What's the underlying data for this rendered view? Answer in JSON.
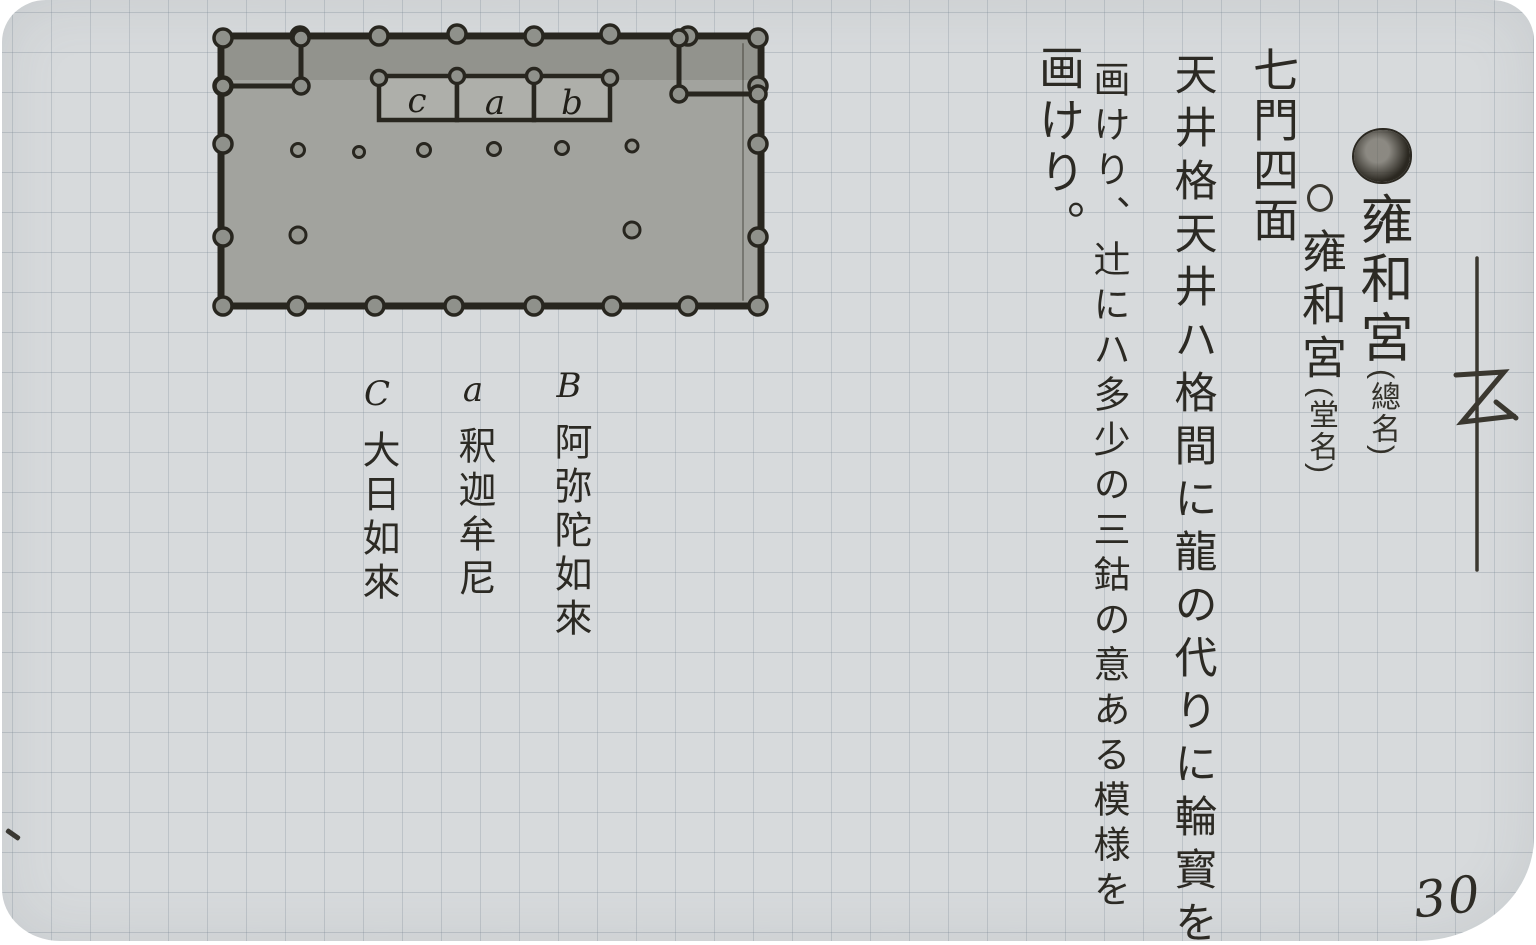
{
  "page": {
    "number": "30",
    "paper_color": "#d7dadc",
    "grid_color": "#7a8893",
    "ink_color": "#2c2a24"
  },
  "plan": {
    "description": "hand-drawn temple floor plan with perimeter columns and three altar bays",
    "altar_labels": [
      "c",
      "a",
      "b"
    ]
  },
  "left_annotations": {
    "columns": [
      {
        "letter": "B",
        "deity": "阿弥陀如來"
      },
      {
        "letter": "a",
        "deity": "釈迦牟尼"
      },
      {
        "letter": "C",
        "deity": "大日如來"
      }
    ]
  },
  "right_text": {
    "columns": [
      {
        "marker": "filled-circle",
        "title": "雍和宮",
        "note": "(總名)"
      },
      {
        "marker": "open-circle",
        "title": "雍和宮",
        "note": "(堂名)"
      },
      {
        "text": "七門四面"
      },
      {
        "text": "天井格天井ハ格間に龍の代りに輪寳を"
      },
      {
        "text": "画けり、辻にハ多少の三鈷の意ある模様を"
      },
      {
        "text": "画けり。"
      }
    ],
    "side_mark": "乙"
  }
}
